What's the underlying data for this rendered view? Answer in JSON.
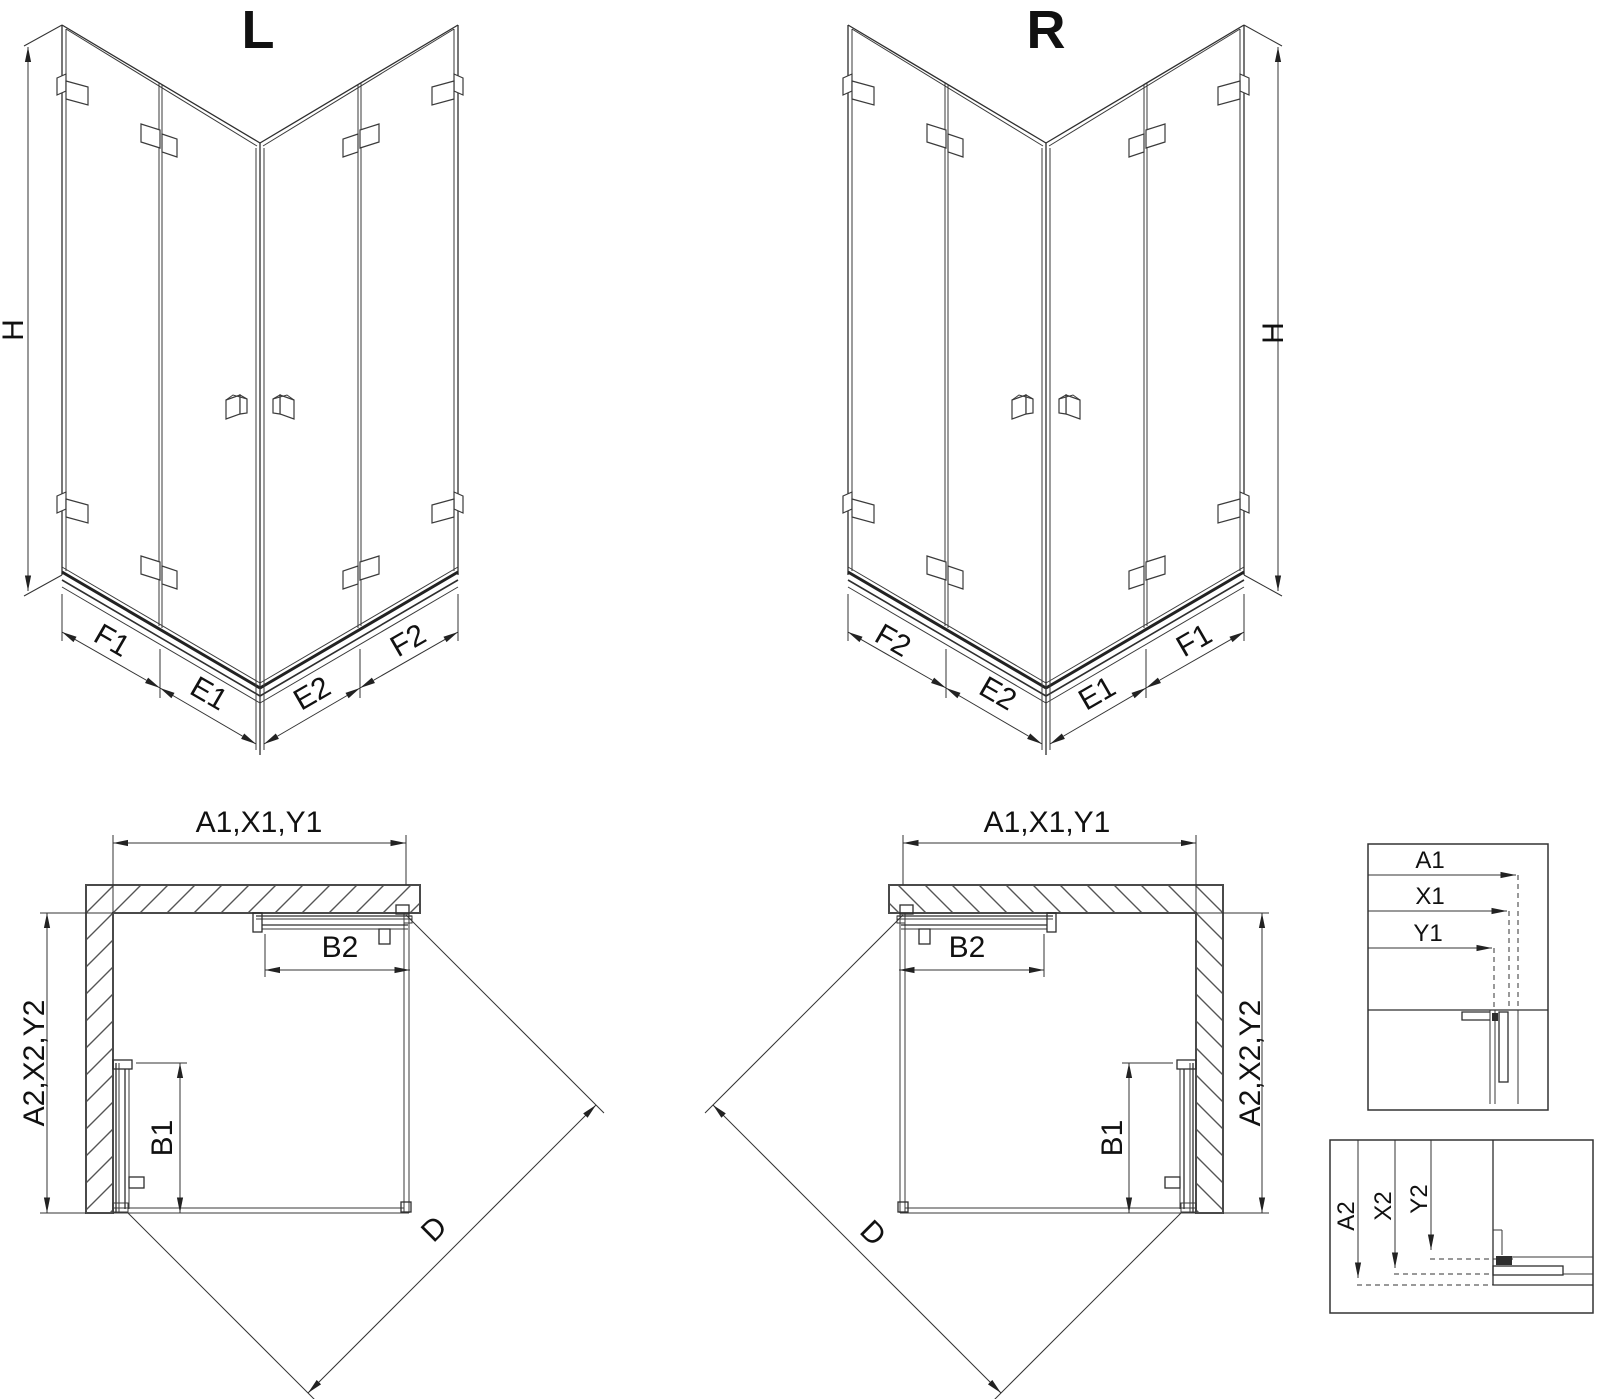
{
  "iso_left": {
    "title": "L",
    "dim_height": "H",
    "dim_f1": "F1",
    "dim_e1": "E1",
    "dim_e2": "E2",
    "dim_f2": "F2"
  },
  "iso_right": {
    "title": "R",
    "dim_height": "H",
    "dim_f1": "F1",
    "dim_e1": "E1",
    "dim_e2": "E2",
    "dim_f2": "F2"
  },
  "plan_left": {
    "dim_width_top": "A1,X1,Y1",
    "dim_depth_side": "A2,X2,Y2",
    "dim_door_top": "B2",
    "dim_door_side": "B1",
    "dim_diagonal": "D"
  },
  "plan_right": {
    "dim_width_top": "A1,X1,Y1",
    "dim_depth_side": "A2,X2,Y2",
    "dim_door_top": "B2",
    "dim_door_side": "B1",
    "dim_diagonal": "D"
  },
  "detail_top": {
    "rows": [
      "A1",
      "X1",
      "Y1"
    ]
  },
  "detail_bottom": {
    "rows": [
      "A2",
      "X2",
      "Y2"
    ]
  },
  "colors": {
    "line": "#2e2e2e",
    "wall": "#4a4a4a",
    "text": "#111111",
    "background": "#ffffff"
  }
}
